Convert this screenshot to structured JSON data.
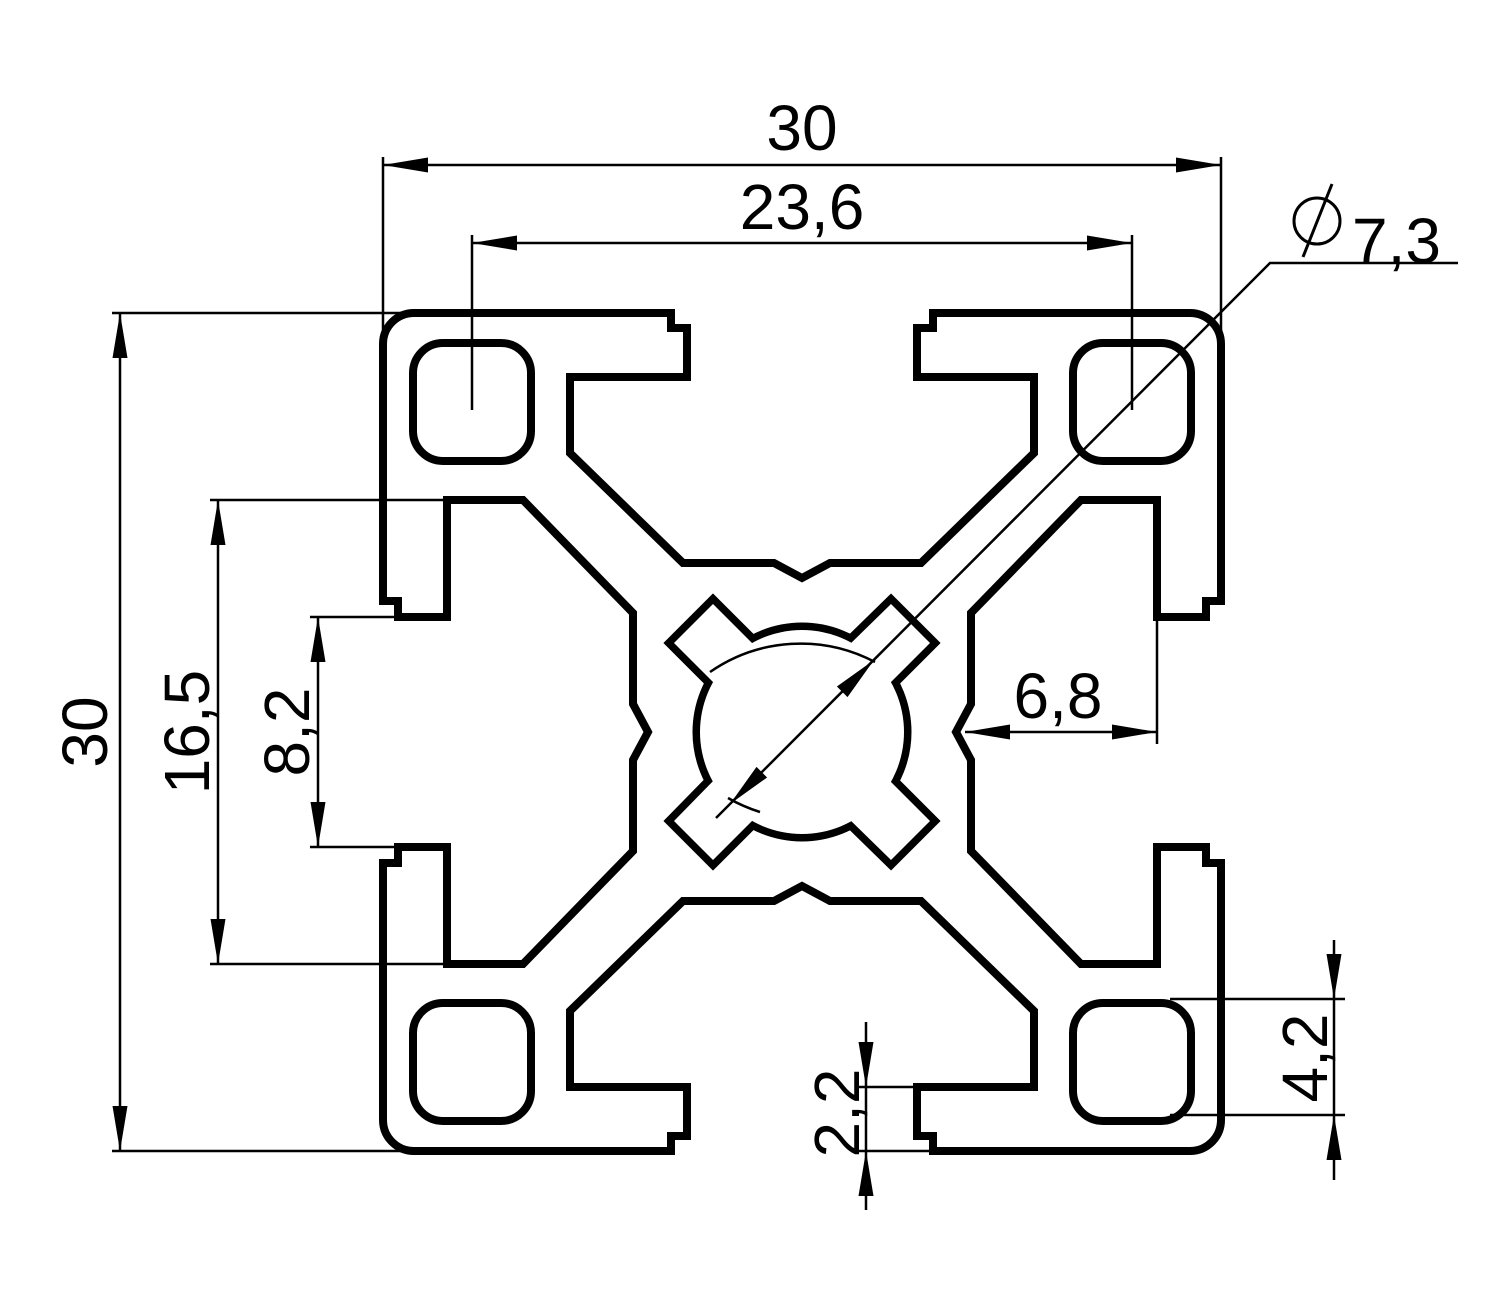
{
  "drawing_type": "profile-cross-section",
  "colors": {
    "background": "#ffffff",
    "line": "#000000"
  },
  "dimensions": {
    "overall_width_top": {
      "value": "30"
    },
    "overall_height_left": {
      "value": "30"
    },
    "hole_pitch": {
      "value": "23,6"
    },
    "center_bore_diameter": {
      "value": "7,3",
      "symbol": "⌀"
    },
    "slot_chamber_width": {
      "value": "16,5"
    },
    "slot_opening_width": {
      "value": "8,2"
    },
    "slot_depth": {
      "value": "6,8"
    },
    "corner_hole_size": {
      "value": "4,2"
    },
    "wall_thickness": {
      "value": "2,2"
    }
  }
}
